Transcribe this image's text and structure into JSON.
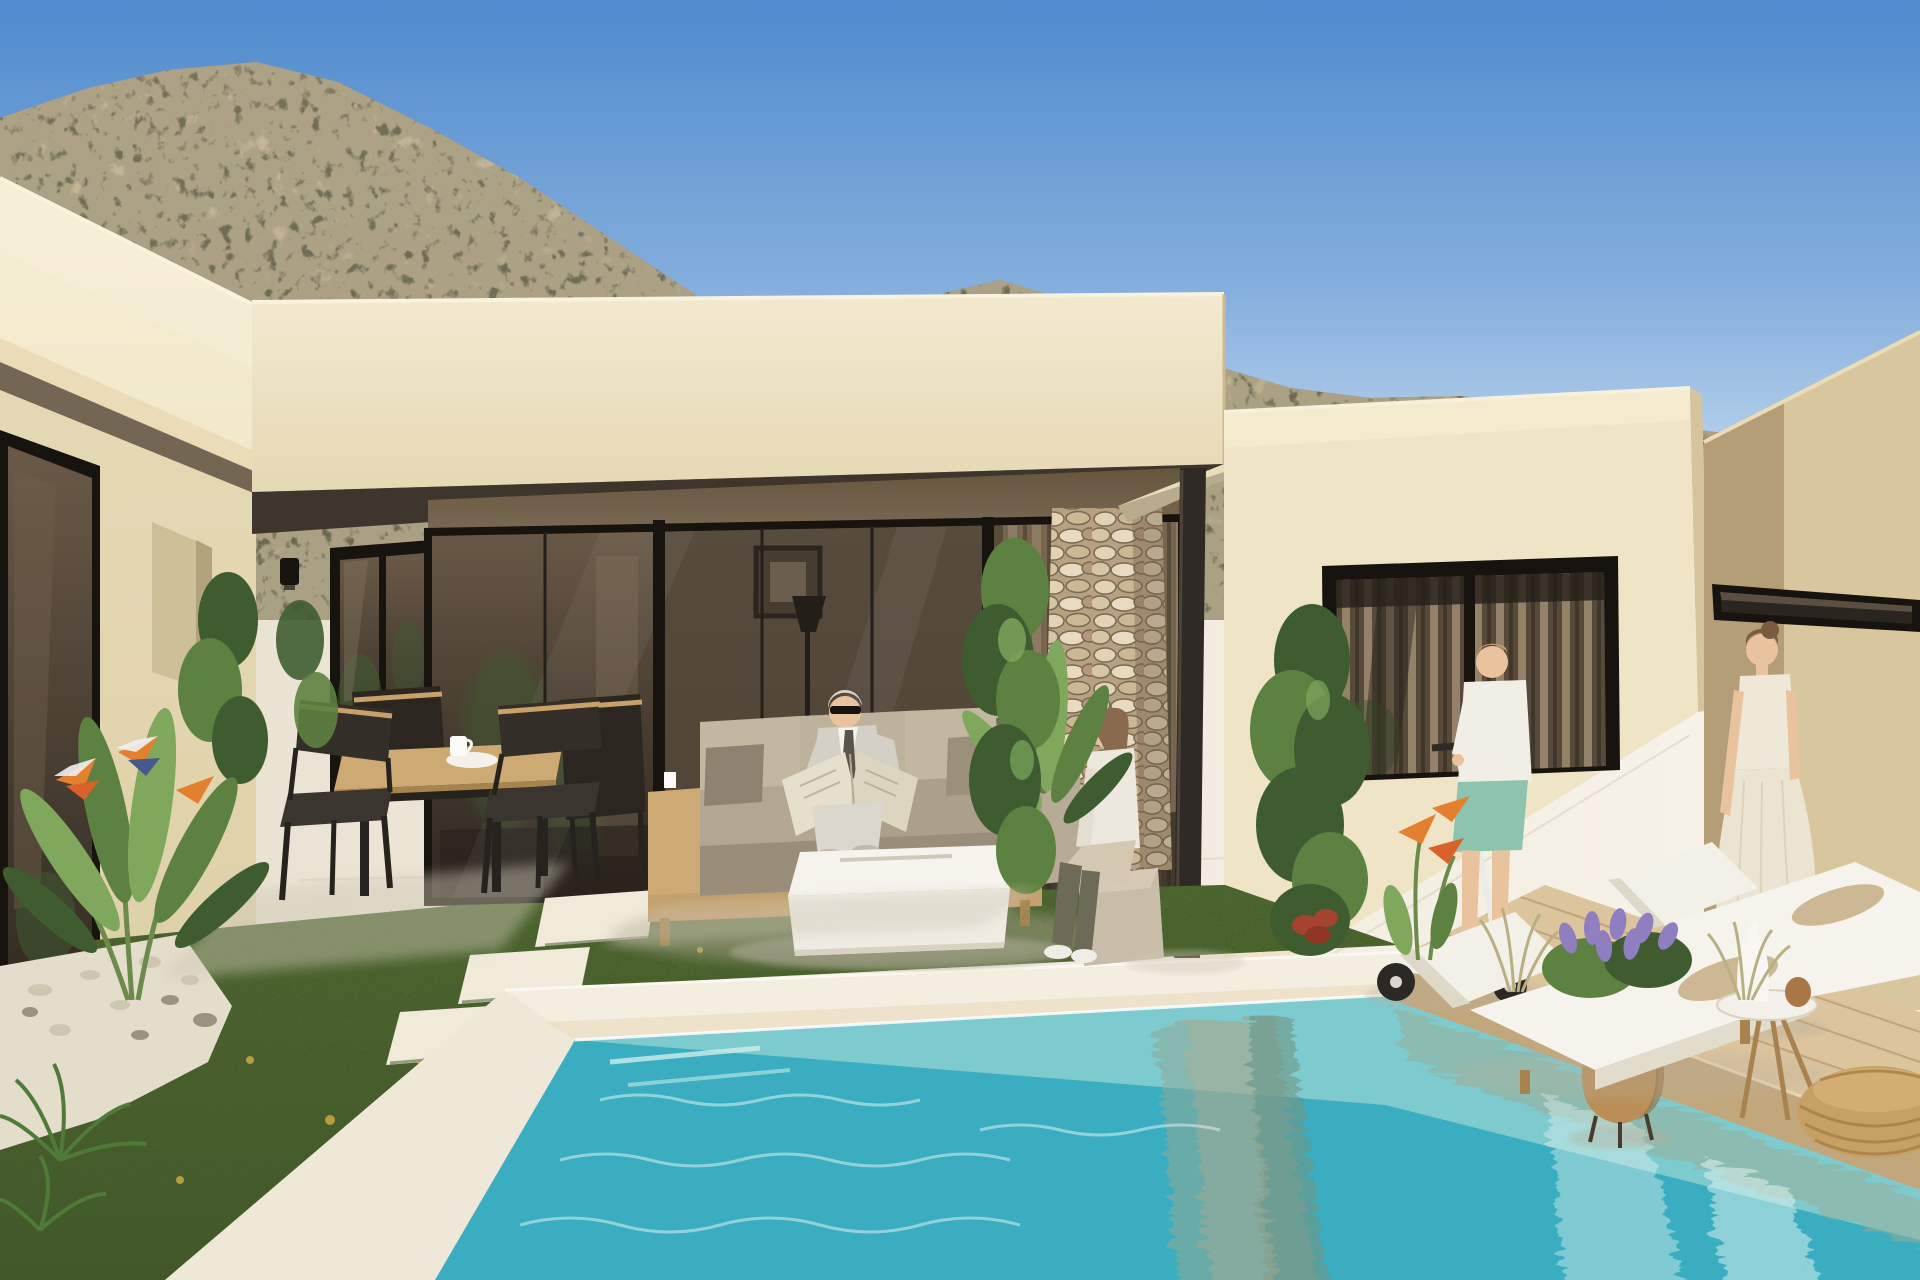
{
  "canvas": {
    "width": 1920,
    "height": 1280
  },
  "scene": {
    "description": "Photorealistic exterior render of a modern single-storey cream villa with covered terrace, courtyard garden and turquoise swimming pool, scrub-covered hillside behind under a clear blue sky",
    "objects": [
      "sky",
      "scrub-hillside",
      "left-wing",
      "terrace-roof-fascia",
      "terrace-glass-wall",
      "stone-pillar",
      "steel-column",
      "right-wing",
      "right-wing-window",
      "neighbor-building",
      "clerestory-window",
      "wall-sconce",
      "dining-table",
      "dining-chairs",
      "coffee-cups",
      "outdoor-sofa",
      "man-reading-newspaper",
      "woman-on-pouf",
      "white-coffee-table",
      "boy-on-scooter",
      "kick-scooter",
      "woman-in-white-dress",
      "terracotta-amphora",
      "sun-loungers",
      "round-side-table",
      "white-vase",
      "rope-pouf",
      "wooden-deck",
      "swimming-pool",
      "pool-coping",
      "lawn",
      "stepping-stones",
      "gravel-bed",
      "bird-of-paradise-plants",
      "lavender-bush",
      "column-shrubs",
      "ornamental-grasses"
    ]
  },
  "palette": {
    "sky-top": "#4f8bcd",
    "sky-mid": "#84aedd",
    "sky-low": "#c9ddf0",
    "mountain-base": "#ab9f83",
    "mountain-dark": "#5f5e48",
    "mountain-light": "#c6b899",
    "wall-cream": "#efe5c6",
    "wall-cream-bright": "#f6eed4",
    "wall-shade": "#d9caa0",
    "fascia": "#f2e9cf",
    "soffit-dark": "#3e362c",
    "terrace-band": "#7c6b54",
    "frame-black": "#17130e",
    "glass-warm": "#6a5947",
    "glass-dark": "#2e2720",
    "curtain": "#8d7a62",
    "stone-bg": "#b7a183",
    "stone-light": "#e2d3b6",
    "steel": "#2f2a25",
    "right-wall": "#d8c69e",
    "right-wall-shade": "#ae9770",
    "paving": "#f0e9dc",
    "paving-bright": "#f8f4ea",
    "grass": "#5a7536",
    "grass-dark": "#42592a",
    "grass-light": "#7c9c4e",
    "gravel": "#e4ddcc",
    "pool-far": "#c7ebe7",
    "pool-mid": "#7fd3d8",
    "pool-near": "#54c3cf",
    "pool-deep": "#3aaec0",
    "pool-reflect": "#8fa895",
    "coping": "#f4eee1",
    "deck": "#dcc49d",
    "deck-dark": "#c3a77c",
    "deck-line": "#b2946a",
    "lounger-white": "#f6f3ec",
    "bolster": "#ccb894",
    "wood": "#cdaa74",
    "wood-dark": "#a8834f",
    "terracotta": "#bb8e58",
    "rope": "#c7a065",
    "skin": "#e9c29e",
    "suit-grey": "#d5d0c5",
    "newspaper": "#e6dfcc",
    "tee-white": "#f1eee6",
    "shorts-teal": "#8cc4ae",
    "dress-white": "#eee8d8",
    "pants-beige": "#d5c8b1",
    "leaf-green": "#5d8140",
    "leaf-dark": "#3f5c31",
    "leaf-light": "#7fa85c",
    "lavender": "#8f7fc0",
    "flower-orange": "#e2802f",
    "flower-red": "#a5432e"
  }
}
